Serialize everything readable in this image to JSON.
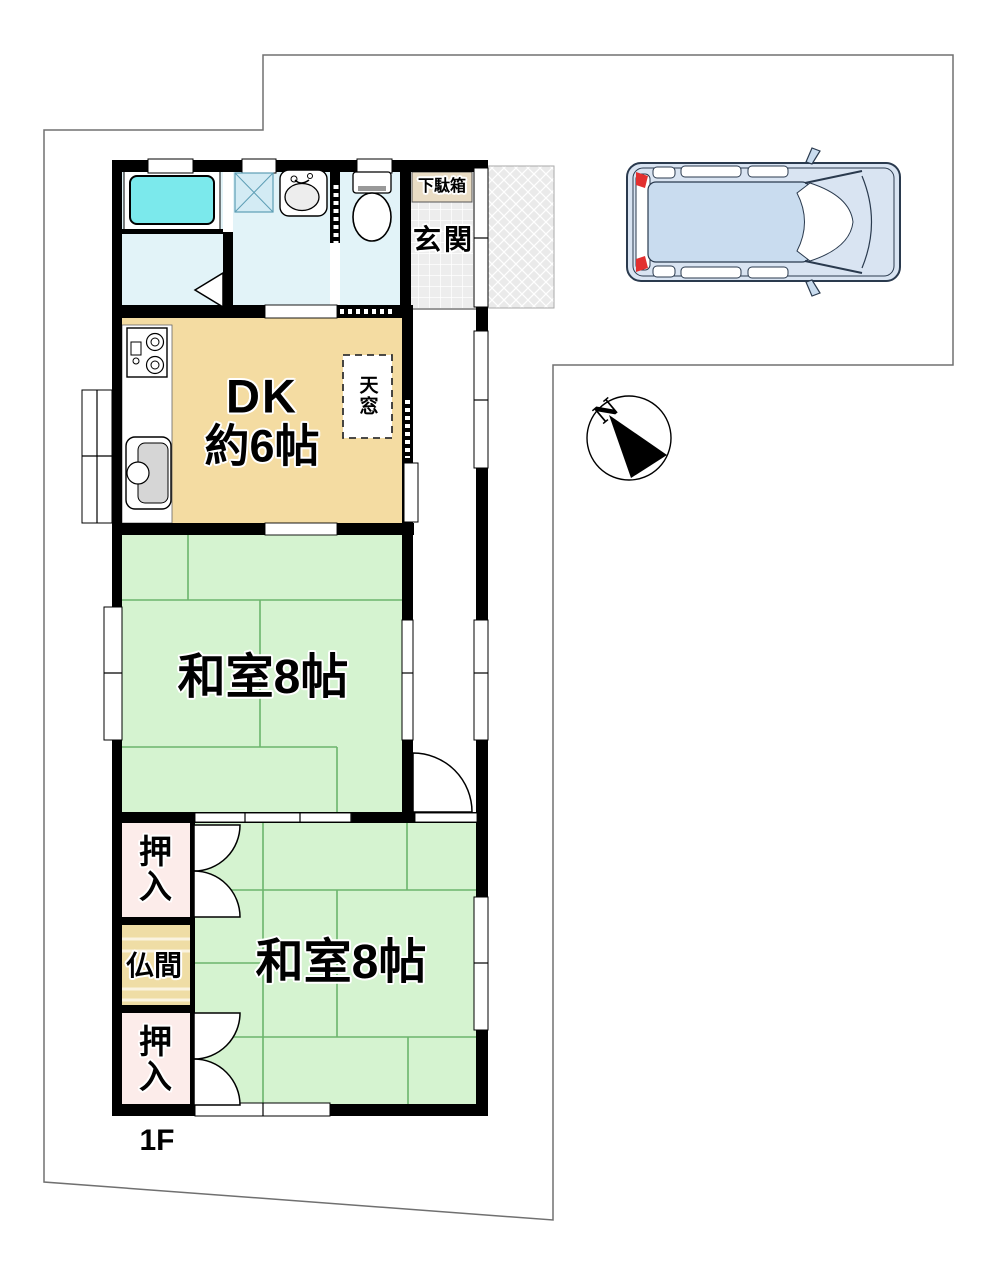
{
  "labels": {
    "floor": "1F",
    "dk_name": "DK",
    "dk_size": "約6帖",
    "washitsu_upper": "和室8帖",
    "washitsu_lower": "和室8帖",
    "genkan": "玄関",
    "getabako": "下駄箱",
    "skylight": "天窓",
    "oshiire_upper": "押入",
    "butsuma": "仏間",
    "oshiire_lower": "押入",
    "compass_north": "N"
  },
  "colors": {
    "tatami_green": "#D5F3D0",
    "tatami_line_green": "#6CB56C",
    "dk_tan": "#F4DCA2",
    "butsuma_tan": "#EFDDA5",
    "closet_pink": "#FCECEA",
    "getabako_beige": "#E9DCC4",
    "wet_room_blue": "#E2F3F8",
    "bathtub_cyan": "#7BE9EC",
    "wall_black": "#000000",
    "boundary_gray": "#707070",
    "car_body": "#D9E4F2",
    "car_cabin": "#C9DCEF",
    "car_outline": "#2A3A4E",
    "tail_light_red": "#E23030"
  }
}
